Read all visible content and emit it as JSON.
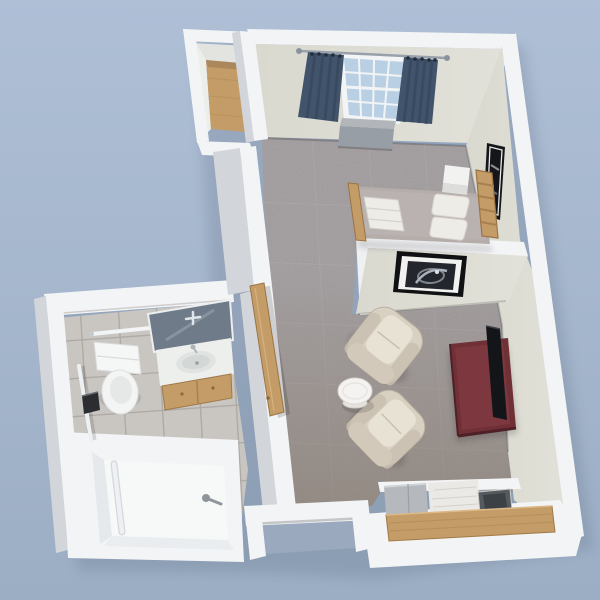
{
  "scene": {
    "title": "Studio Apartment 3D Floor Plan Render",
    "type": "3d-floorplan-render",
    "view": "perspective top-down (dollhouse view)",
    "rooms": [
      {
        "name": "Bedroom",
        "furniture": [
          "bed with wood headboard and footboard",
          "white nightstand",
          "window with blue curtains",
          "radiator under window",
          "tall framed wall art",
          "wood-floor closet"
        ]
      },
      {
        "name": "Living Room",
        "furniture": [
          "two cream armchairs",
          "round white side table",
          "maroon tv console",
          "flat-screen tv",
          "framed abstract wall art"
        ]
      },
      {
        "name": "Bathroom",
        "furniture": [
          "toilet",
          "vanity with oval sink and wood cabinet",
          "leaning mirror",
          "walk-in bathtub shower with grab bar",
          "wall grab bars",
          "towel bar",
          "black dispenser"
        ]
      },
      {
        "name": "Kitchenette",
        "furniture": [
          "mini fridge",
          "white counter",
          "dark sink basin",
          "wood front panel"
        ]
      },
      {
        "name": "Entry",
        "furniture": [
          "open entry doorway with white frame",
          "open wood bathroom door"
        ]
      }
    ]
  },
  "colors": {
    "bg_top": "#aebfd6",
    "bg_bottom": "#9caec4",
    "wall_white": "#f3f4f6",
    "wall_shadow": "#d2d6db",
    "wall_face": "#d9d9cf",
    "carpet": "#a09b9d",
    "carpet_south_tint": "#7e6f5c",
    "tile": "#c9c6c2",
    "wood": "#c49c68",
    "curtain": "#42546c",
    "window_glass": "#b9cfe3",
    "radiator": "#989ea5",
    "bed": "#b4adaa",
    "linen": "#eeece7",
    "chair": "#d8d0c1",
    "console": "#6f3036",
    "tv": "#141519",
    "mirror": "#6f7b88",
    "art_dark": "#23262c",
    "sink_dark": "#555a5f",
    "fridge": "#b5b9bd",
    "ground": "#9aa9bd"
  }
}
